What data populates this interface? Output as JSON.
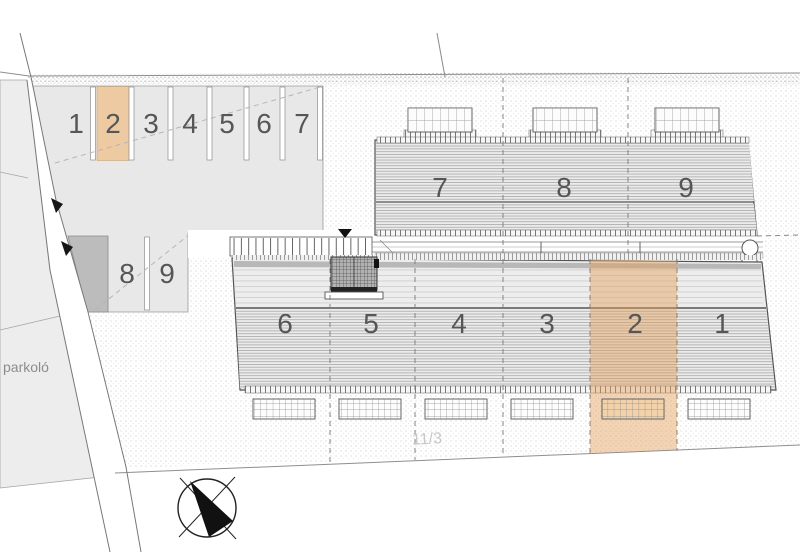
{
  "meta": {
    "type": "architectural site plan"
  },
  "colors": {
    "paper": "#ffffff",
    "lot_gray": "#e8e8e8",
    "highlight": "#eecaa2",
    "highlight_overlay": "rgba(226,160,88,0.45)"
  },
  "parking": {
    "top_row": [
      "1",
      "2",
      "3",
      "4",
      "5",
      "6",
      "7"
    ],
    "side_row": [
      "8",
      "9"
    ],
    "highlighted_space": "2"
  },
  "buildings": {
    "north_units": [
      "7",
      "8",
      "9"
    ],
    "south_units": [
      "6",
      "5",
      "4",
      "3",
      "2",
      "1"
    ],
    "highlighted_unit": "2"
  },
  "labels": {
    "parking_area": "parkoló",
    "parcel_number": "11/3"
  }
}
